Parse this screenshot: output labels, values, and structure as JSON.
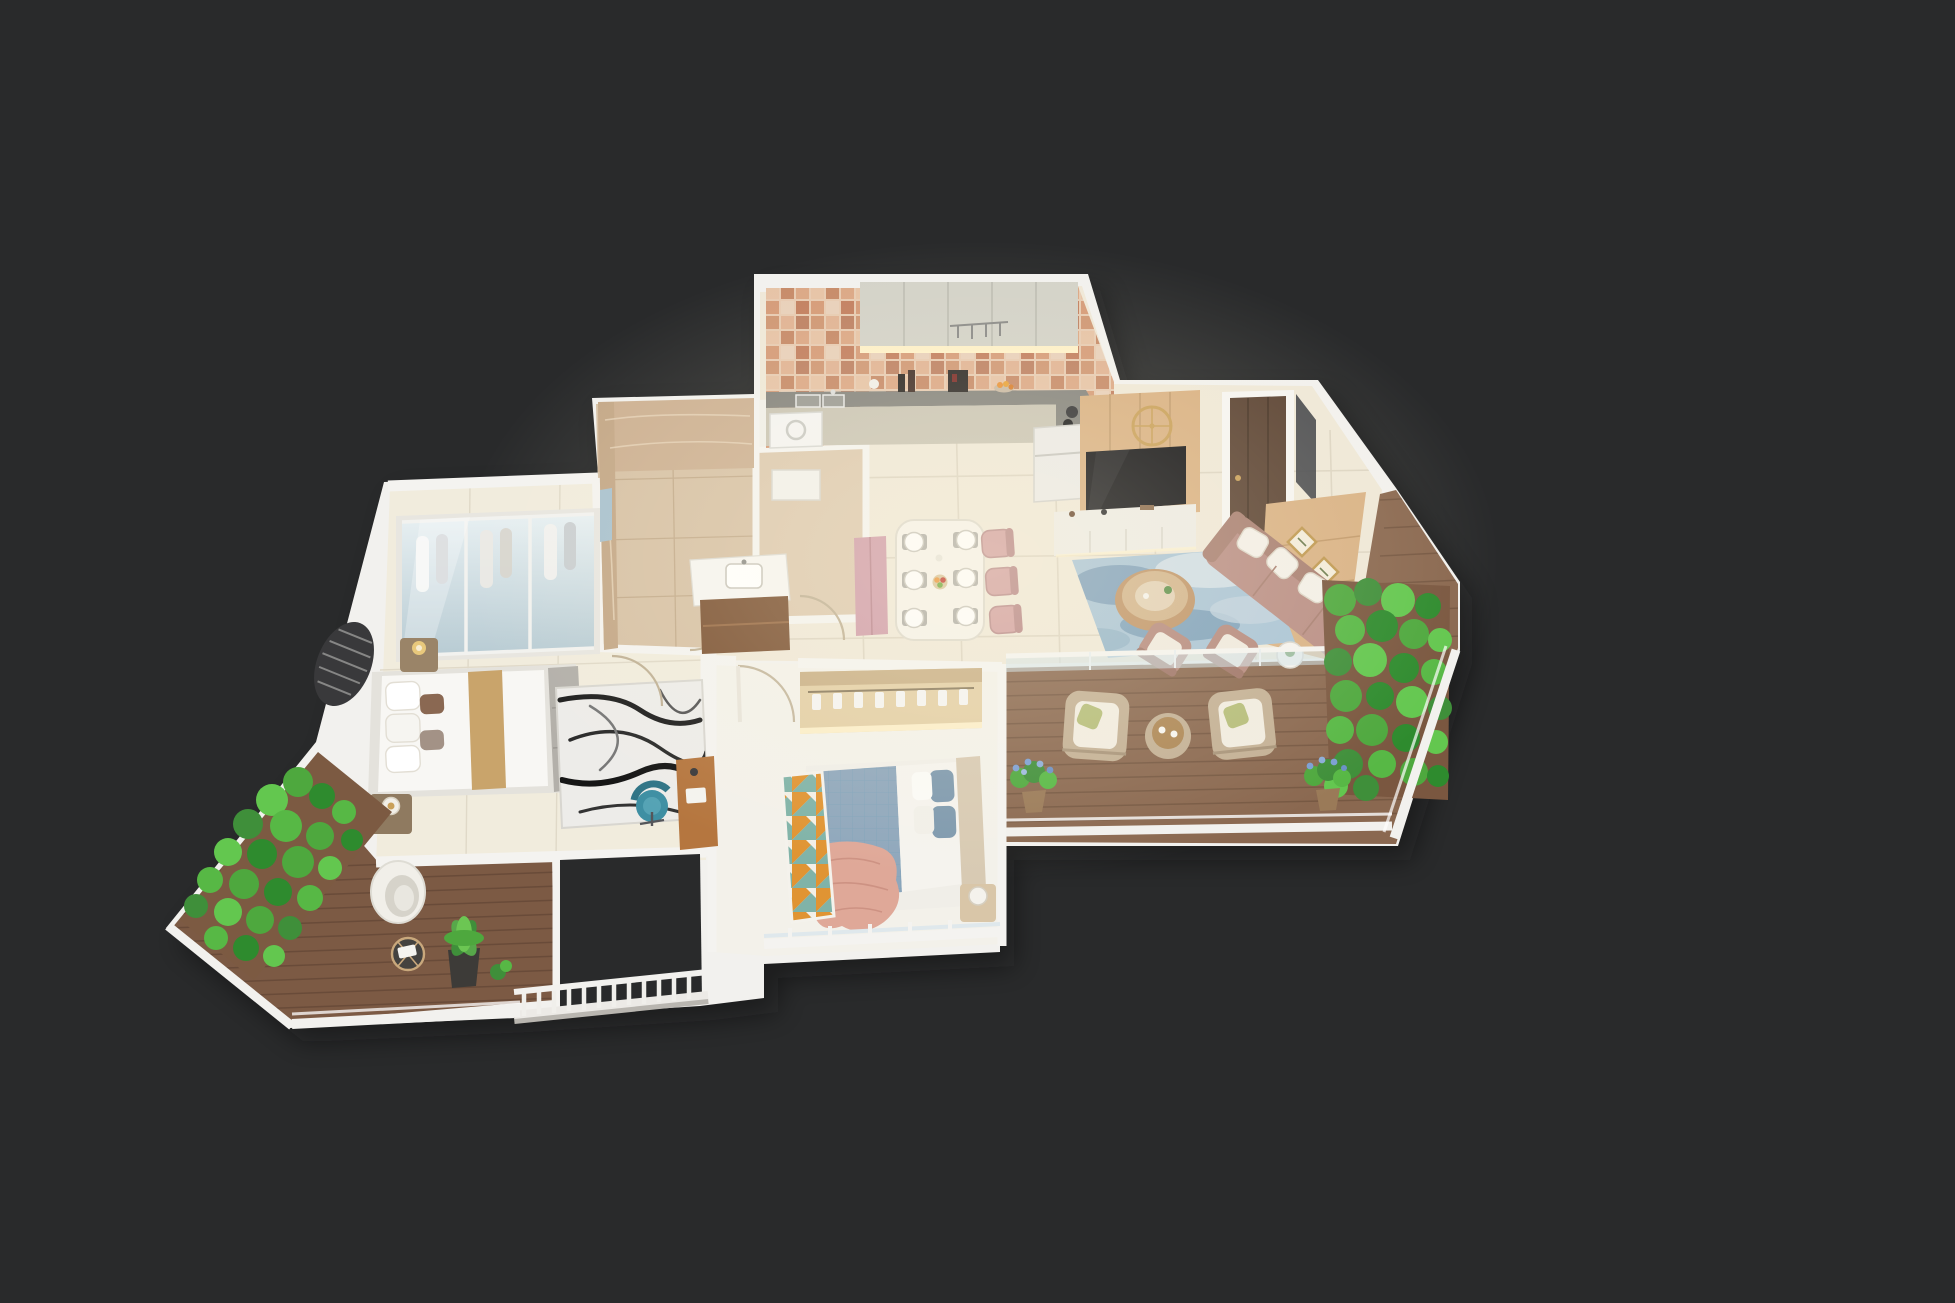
{
  "scene": {
    "title": "isometric-3d-apartment-floor-plan-render",
    "background": "#292a2b",
    "palette": {
      "wall": "#f2f1ee",
      "wall_shade": "#d9d5cc",
      "floor_cream": "#efe8d8",
      "floor_cream2": "#f1ecdd",
      "floor_white": "#f3f1ea",
      "marble_floor": "#d7c2a6",
      "marble_floor2": "#ddcab0",
      "marble_wall": "#cdb193",
      "deck_right": "#8a6850",
      "deck_left": "#7c5a44",
      "cabinet": "#d3d2c8",
      "counter_top": "#85847e",
      "counter_front": "#cac5b5",
      "wood_panel": "#d9b183",
      "tv_black": "#141417",
      "console_white": "#edebe5",
      "door_wood": "#5c4434",
      "frames_wall": "#d9b285",
      "sofa": "#b98e85",
      "sofa_back": "#a87f72",
      "armchair": "#b5897e",
      "rug_blue": "#a9c4d6",
      "rug_blue_dark": "#6f93b0",
      "dining_table": "#f5f2ea",
      "chair_pink": "#d2a1a1",
      "bench_pink": "#d09daa",
      "wardrobe_frame": "#e8e6e0",
      "bed_white": "#f8f7f4",
      "bed_tan": "#c9a46b",
      "foot_bench": "#b3b0aa",
      "rug_marble": "#edece9",
      "duvet_blue": "#8fa7bc",
      "sheet_white": "#f5f3ee",
      "headboard2": "#d8cab3",
      "throw_pink": "#dfa898",
      "wardrobe2": "#e3cfa6",
      "greenery": "#4ea83e",
      "flower_blue": "#7b9fd4",
      "wicker": "#c3b095",
      "cushion_white": "#f1ece1",
      "pillow_green": "#b5bd7a",
      "teal_chair": "#3e8fa3",
      "desk_wood": "#b5763f",
      "vanity_wood": "#7d5435",
      "gold": "#c9a05a",
      "glow": "#fff3cf"
    },
    "rooms": [
      {
        "name": "kitchen",
        "items": [
          "mosaic-backsplash",
          "upper-cabinets",
          "under-cabinet-light",
          "counter-with-sink",
          "gas-hob",
          "utensil-rack",
          "refrigerator"
        ]
      },
      {
        "name": "living-dining",
        "items": [
          "entrance-door",
          "tv-wood-panel",
          "wall-clock",
          "tv",
          "tv-console",
          "blue-area-rug",
          "round-coffee-table",
          "sofa-with-pillows",
          "two-accent-armchairs",
          "side-table",
          "gallery-frames-wall",
          "dining-table-for-six",
          "pink-dining-chairs",
          "dining-bench"
        ]
      },
      {
        "name": "master-bedroom",
        "items": [
          "sliding-glass-wardrobe",
          "double-bed",
          "tan-bed-runner",
          "foot-bench",
          "marble-print-rug",
          "nightstand-lamps",
          "study-desk",
          "teal-desk-chair",
          "ac-louver"
        ]
      },
      {
        "name": "bedroom-2",
        "items": [
          "open-wardrobe-with-hangers",
          "quilted-blue-bed",
          "pink-throw-blanket",
          "geometric-rug",
          "nightstand-lamp",
          "door-swing",
          "window-railing"
        ]
      },
      {
        "name": "bathroom-1",
        "items": [
          "marble-walls",
          "marble-tile-floor",
          "wall-mirror",
          "door-swing"
        ]
      },
      {
        "name": "bathroom-2",
        "items": [
          "shower-tray",
          "double-vanity",
          "walnut-vanity-cabinet"
        ]
      },
      {
        "name": "utility",
        "items": [
          "washing-machine"
        ]
      },
      {
        "name": "balcony-right",
        "items": [
          "wood-deck",
          "glass-railing",
          "two-wicker-armchairs",
          "wicker-side-table",
          "vertical-garden-wall",
          "blue-flower-pots",
          "chamfered-parapet"
        ]
      },
      {
        "name": "balcony-left",
        "items": [
          "wood-deck",
          "vertical-garden-wall",
          "egg-chair",
          "wire-side-table",
          "potted-fern",
          "parapet-railing"
        ]
      },
      {
        "name": "entry-void",
        "items": [
          "baluster-railing"
        ]
      }
    ]
  }
}
